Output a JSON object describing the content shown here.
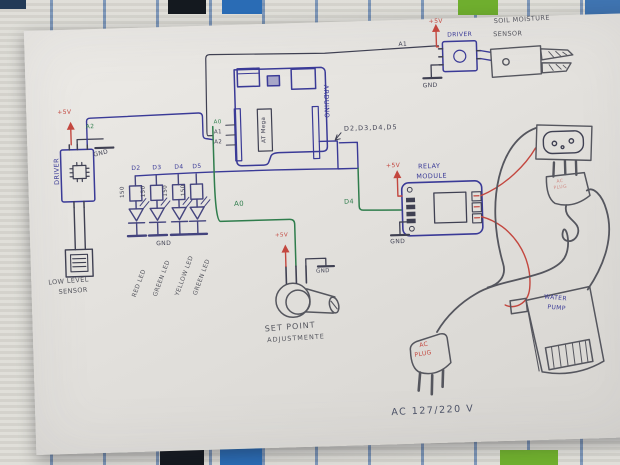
{
  "colors": {
    "ink_blue": "#3a3a97",
    "ink_dark": "#3f4052",
    "pencil": "#55565e",
    "green": "#2f7d4c",
    "red": "#c3473f"
  },
  "power": {
    "plus5v": "+5V",
    "gnd": "GND"
  },
  "left_driver": {
    "name": "DRIVER",
    "pin": "A2"
  },
  "low_level_sensor": {
    "line1": "LOW LEVEL",
    "line2": "SENSOR"
  },
  "leds": {
    "pins": [
      "D2",
      "D3",
      "D4",
      "D5"
    ],
    "resistor": "150",
    "names": [
      "RED LED",
      "GREEN LED",
      "YELLOW LED",
      "GREEN LED"
    ]
  },
  "arduino": {
    "name": "ARDUINO",
    "chip": "AT Mega",
    "pin_a0": "A0",
    "pin_a1": "A1",
    "pin_a2": "A2",
    "digital_bundle": "D2,D3,D4,D5",
    "wire_a0": "A0",
    "wire_a1": "A1",
    "wire_d4": "D4"
  },
  "soil": {
    "driver": "DRIVER",
    "sensor_line1": "SOIL MOISTURE",
    "sensor_line2": "SENSOR"
  },
  "relay": {
    "line1": "RELAY",
    "line2": "MODULE"
  },
  "pot": {
    "line1": "SET POINT",
    "line2": "ADJUSTMENTE"
  },
  "ac_plug": {
    "line1": "AC",
    "line2": "PLUG"
  },
  "water_pump": {
    "line1": "WATER",
    "line2": "PUMP"
  },
  "mains": {
    "voltage": "AC 127/220 V"
  }
}
